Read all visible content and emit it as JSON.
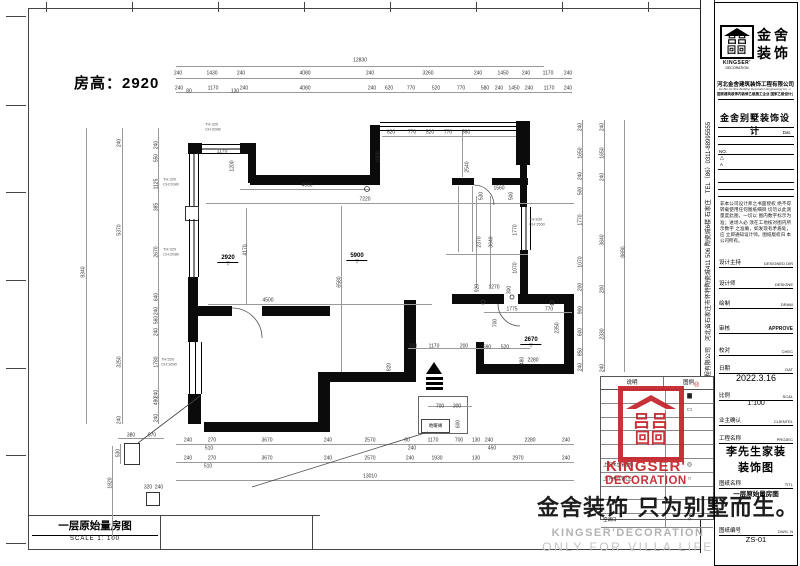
{
  "sheet": {
    "room_height_label": "房高：2920",
    "bottom_title": "一层原始量房图",
    "bottom_scale": "SCALE 1: 100"
  },
  "watermark": {
    "cn": "金舍装饰 只为别墅而生。",
    "en1": "KINGSER'DECORATION",
    "en2": "ONLY FOR VILLA LIFE",
    "red": "#c4242b"
  },
  "red_logo": {
    "line1": "KINGSER'",
    "line2": "DECORATION",
    "registered": "®",
    "glyph1": "回回",
    "glyph2": "吕吕"
  },
  "titleblock": {
    "brand_cn1": "金舍",
    "brand_cn2": "装饰",
    "brand_en1": "KINGSER'",
    "brand_en2": "DECORATION",
    "company": "河北金舍建筑装饰工程有限公司",
    "company_en": "He Bei Jin She Building Decoration Engineering Co., L",
    "cert_line": "国家建筑装饰内装修乙级施工企业 国家乙级设计企业",
    "dept_title": "金舍别墅装饰设计",
    "dat_label": "Dat.",
    "no_label": "NO.",
    "rev_tri": "△",
    "rev_a": "A",
    "disclaimer": "非本公司设计师之书面授权 绝不得转载使用任何图纸细目 切勿以此测量度此图，一切以 图内数字标示为准；进场人必 须在工地核对图内所示数字 之准确，如发现有矛盾处，应 立即通知设计师。图纸版权归 本公司所有。",
    "fields": [
      {
        "cn": "设计主持",
        "en": "DESIGNED DIR"
      },
      {
        "cn": "设计师",
        "en": "DESIGNE"
      },
      {
        "cn": "绘制",
        "en": "DRAW"
      },
      {
        "cn": "审核",
        "en": "APPROVE"
      },
      {
        "cn": "校对",
        "en": "CHEC"
      },
      {
        "cn": "日期",
        "en": "DAT",
        "value": "2022.3.16"
      },
      {
        "cn": "比例",
        "en": "SCAL",
        "value": "1:100"
      },
      {
        "cn": "业主确认",
        "en": "CLIENTEL"
      },
      {
        "cn": "工程名称",
        "en": "PROJEC",
        "value": "李先生家装",
        "value2": "装饰图"
      },
      {
        "cn": "图纸名称",
        "en": "TITL",
        "value": "一层原始量房图"
      },
      {
        "cn": "图纸编号",
        "en": "DWG. N",
        "value": "ZS-01"
      }
    ],
    "vertical_strip": "河北金舍建筑装饰工程有限公司　河北省石家庄市怀特陶瓷城411 506 陶瓷城6楼 石家庄　TEL（86）0311-88995555"
  },
  "legend": {
    "col1": "说明",
    "col2": "图例",
    "rows": [
      [
        "",
        "▆"
      ],
      [
        "",
        "▭"
      ],
      [
        "",
        ""
      ],
      [
        "",
        ""
      ],
      [
        "",
        ""
      ],
      [
        "上下水立管(厨)",
        "◎"
      ],
      [
        "上下水立管(卫)",
        "○"
      ],
      [
        "",
        ""
      ],
      [
        "",
        ""
      ],
      [
        "空调口",
        "✧"
      ]
    ]
  },
  "plan": {
    "floor_heating_valve_label": "地暖阀",
    "dim_labels": [
      [
        "12830",
        360,
        61
      ],
      [
        "240",
        178,
        74
      ],
      [
        "1430",
        212,
        74
      ],
      [
        "240",
        241,
        74
      ],
      [
        "4080",
        305,
        74
      ],
      [
        "240",
        370,
        74
      ],
      [
        "3260",
        428,
        74
      ],
      [
        "240",
        478,
        74
      ],
      [
        "1450",
        503,
        74
      ],
      [
        "240",
        526,
        74
      ],
      [
        "1170",
        548,
        74
      ],
      [
        "240",
        568,
        74
      ],
      [
        "240",
        179,
        89
      ],
      [
        "80",
        189,
        92
      ],
      [
        "1170",
        213,
        89
      ],
      [
        "130",
        235,
        92
      ],
      [
        "240",
        244,
        89
      ],
      [
        "4080",
        305,
        89
      ],
      [
        "240",
        372,
        89
      ],
      [
        "620",
        389,
        89
      ],
      [
        "770",
        411,
        89
      ],
      [
        "520",
        436,
        89
      ],
      [
        "770",
        461,
        89
      ],
      [
        "580",
        485,
        89
      ],
      [
        "240",
        499,
        89
      ],
      [
        "1450",
        514,
        89
      ],
      [
        "240",
        529,
        89
      ],
      [
        "1170",
        549,
        89
      ],
      [
        "240",
        568,
        89
      ],
      [
        "620",
        391,
        133
      ],
      [
        "770",
        412,
        133
      ],
      [
        "520",
        430,
        133
      ],
      [
        "770",
        448,
        133
      ],
      [
        "580",
        466,
        133
      ],
      [
        "240",
        188,
        441
      ],
      [
        "270",
        212,
        441
      ],
      [
        "3670",
        267,
        441
      ],
      [
        "240",
        328,
        441
      ],
      [
        "2570",
        370,
        441
      ],
      [
        "60",
        407,
        441
      ],
      [
        "1170",
        433,
        441
      ],
      [
        "700",
        459,
        441
      ],
      [
        "130",
        476,
        441
      ],
      [
        "240",
        489,
        441
      ],
      [
        "2280",
        530,
        441
      ],
      [
        "240",
        566,
        441
      ],
      [
        "510",
        209,
        449
      ],
      [
        "240",
        412,
        449
      ],
      [
        "450",
        492,
        449
      ],
      [
        "240",
        188,
        459
      ],
      [
        "270",
        212,
        459
      ],
      [
        "3670",
        267,
        459
      ],
      [
        "240",
        328,
        459
      ],
      [
        "2570",
        370,
        459
      ],
      [
        "240",
        410,
        459
      ],
      [
        "1930",
        437,
        459
      ],
      [
        "130",
        476,
        459
      ],
      [
        "2970",
        518,
        459
      ],
      [
        "240",
        566,
        459
      ],
      [
        "510",
        208,
        467
      ],
      [
        "13010",
        370,
        477
      ],
      [
        "9340",
        84,
        272,
        1
      ],
      [
        "240",
        120,
        143,
        1
      ],
      [
        "5370",
        120,
        230,
        1
      ],
      [
        "3250",
        120,
        362,
        1
      ],
      [
        "240",
        120,
        420,
        1
      ],
      [
        "240",
        157,
        145,
        1
      ],
      [
        "550",
        157,
        158,
        1
      ],
      [
        "1125",
        157,
        184,
        1
      ],
      [
        "385",
        157,
        207,
        1
      ],
      [
        "2670",
        157,
        252,
        1
      ],
      [
        "640",
        157,
        297,
        1
      ],
      [
        "240",
        157,
        311,
        1
      ],
      [
        "560",
        157,
        320,
        1
      ],
      [
        "240",
        157,
        332,
        1
      ],
      [
        "1780",
        157,
        362,
        1
      ],
      [
        "240",
        157,
        394,
        1
      ],
      [
        "490",
        157,
        401,
        1
      ],
      [
        "240",
        157,
        418,
        1
      ],
      [
        "240",
        581,
        127,
        1
      ],
      [
        "1650",
        581,
        153,
        1
      ],
      [
        "240",
        581,
        176,
        1
      ],
      [
        "500",
        581,
        191,
        1
      ],
      [
        "1770",
        581,
        220,
        1
      ],
      [
        "1070",
        581,
        262,
        1
      ],
      [
        "200",
        581,
        287,
        1
      ],
      [
        "900",
        581,
        310,
        1
      ],
      [
        "600",
        581,
        332,
        1
      ],
      [
        "850",
        581,
        352,
        1
      ],
      [
        "240",
        581,
        367,
        1
      ],
      [
        "240",
        603,
        127,
        1
      ],
      [
        "1650",
        603,
        153,
        1
      ],
      [
        "240",
        603,
        177,
        1
      ],
      [
        "3640",
        603,
        240,
        1
      ],
      [
        "200",
        603,
        289,
        1
      ],
      [
        "2330",
        603,
        334,
        1
      ],
      [
        "240",
        603,
        368,
        1
      ],
      [
        "8690",
        624,
        252,
        1
      ],
      [
        "1170",
        222,
        152
      ],
      [
        "1200",
        233,
        166,
        1
      ],
      [
        "4560",
        307,
        186
      ],
      [
        "7220",
        365,
        200
      ],
      [
        "4170",
        246,
        250,
        1
      ],
      [
        "4500",
        268,
        301
      ],
      [
        "6580",
        340,
        282,
        1
      ],
      [
        "1860",
        379,
        157,
        1
      ],
      [
        "2540",
        468,
        167,
        1
      ],
      [
        "1560",
        499,
        189
      ],
      [
        "530",
        482,
        196,
        1
      ],
      [
        "500",
        512,
        196,
        1
      ],
      [
        "2370",
        480,
        242,
        1
      ],
      [
        "3640",
        492,
        242,
        1
      ],
      [
        "1770",
        516,
        230,
        1
      ],
      [
        "1070",
        516,
        268,
        1
      ],
      [
        "1270",
        494,
        288
      ],
      [
        "300",
        510,
        290,
        1
      ],
      [
        "920",
        478,
        288,
        1
      ],
      [
        "1775",
        512,
        310
      ],
      [
        "770",
        549,
        310
      ],
      [
        "700",
        496,
        323,
        1
      ],
      [
        "2350",
        558,
        328,
        1
      ],
      [
        "2280",
        533,
        361
      ],
      [
        "480",
        523,
        361,
        1
      ],
      [
        "690",
        487,
        348
      ],
      [
        "520",
        505,
        348
      ],
      [
        "200",
        464,
        347
      ],
      [
        "1170",
        434,
        347
      ],
      [
        "300",
        413,
        347
      ],
      [
        "820",
        390,
        367,
        1
      ],
      [
        "700",
        440,
        407
      ],
      [
        "300",
        457,
        407
      ],
      [
        "600",
        459,
        424,
        1
      ],
      [
        "380",
        131,
        436
      ],
      [
        "970",
        152,
        436
      ],
      [
        "530",
        119,
        453,
        1
      ],
      [
        "1820",
        111,
        483,
        1
      ],
      [
        "320",
        148,
        488
      ],
      [
        "240",
        159,
        488
      ]
    ],
    "window_labels": [
      [
        "TH:320",
        "CH:2080",
        213,
        127
      ],
      [
        "TH:320",
        "CH:2080",
        171,
        182
      ],
      [
        "TH:320",
        "CH:2080",
        171,
        252
      ],
      [
        "TH:520",
        "CH:1690",
        169,
        362
      ],
      [
        "TH:830",
        "CH:1560",
        537,
        222
      ]
    ],
    "levels": [
      [
        "2920",
        228,
        246
      ],
      [
        "5900",
        357,
        244
      ],
      [
        "2670",
        531,
        328
      ]
    ]
  }
}
